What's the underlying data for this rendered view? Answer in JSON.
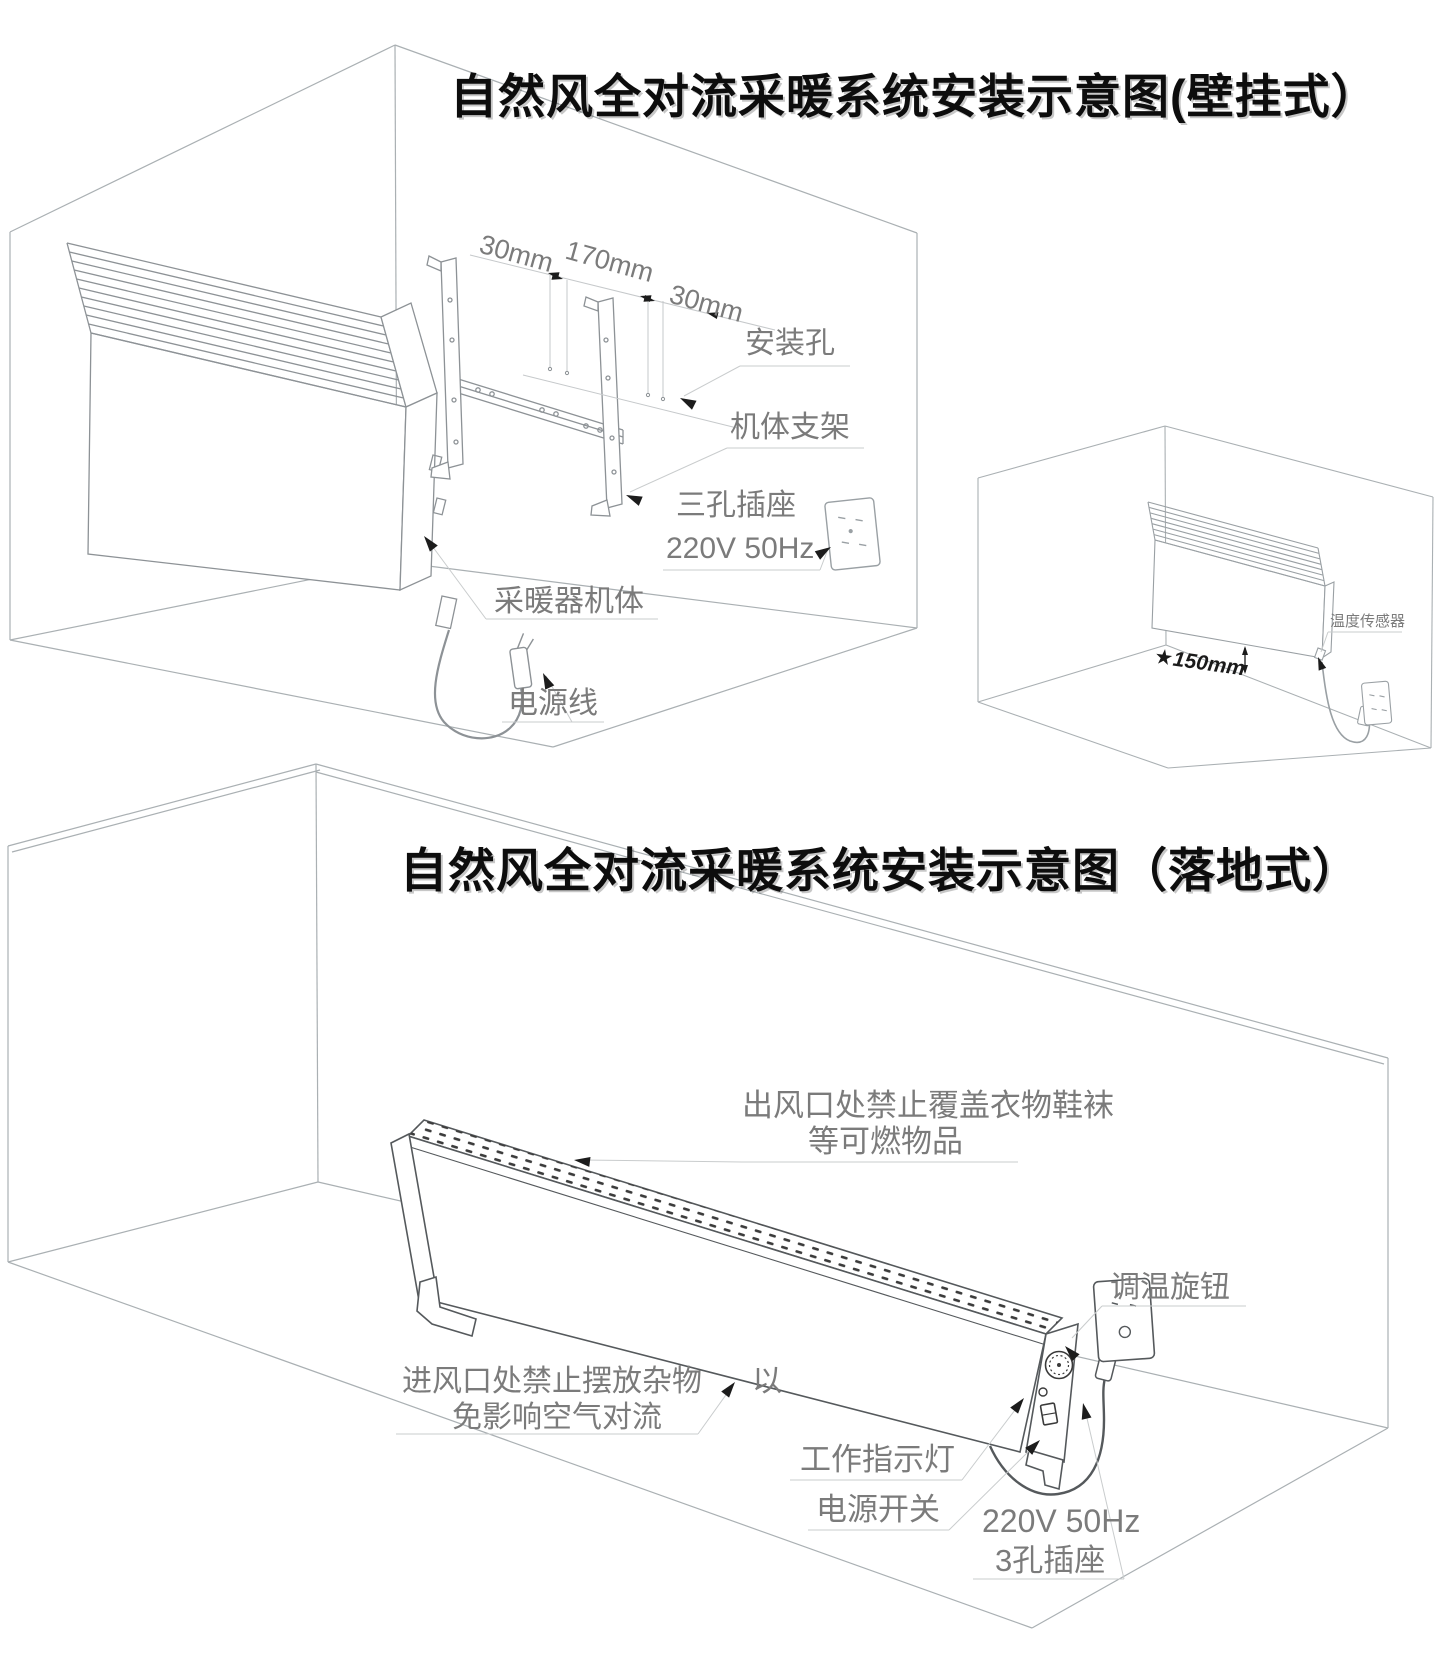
{
  "page": {
    "background": "#ffffff",
    "label_color": "#7b7b7b",
    "line_color": "#aeb2b5",
    "dark_line_color": "#55595c",
    "arrow_color": "#1c1c1c"
  },
  "wall_mounted": {
    "title": "自然风全对流采暖系统安装示意图(壁挂式）",
    "dim_left": "30mm",
    "dim_center": "170mm",
    "dim_right": "30mm",
    "label_mounting_hole": "安装孔",
    "label_bracket": "机体支架",
    "label_socket_type": "三孔插座",
    "label_socket_power": "220V 50Hz",
    "label_heater_body": "采暖器机体",
    "label_power_cord": "电源线",
    "inset": {
      "label_height": "★150mm",
      "label_temp_sensor": "温度传感器"
    }
  },
  "floor_standing": {
    "title": "自然风全对流采暖系统安装示意图（落地式）",
    "warn_outlet_line1": "出风口处禁止覆盖衣物鞋袜",
    "warn_outlet_line2": "等可燃物品",
    "label_knob": "调温旋钮",
    "warn_inlet_line1": "进风口处禁止摆放杂物",
    "warn_inlet_suffix": "以",
    "warn_inlet_line2": "免影响空气对流",
    "label_indicator": "工作指示灯",
    "label_power_switch": "电源开关",
    "label_socket_power": "220V 50Hz",
    "label_socket_type": "3孔插座"
  }
}
